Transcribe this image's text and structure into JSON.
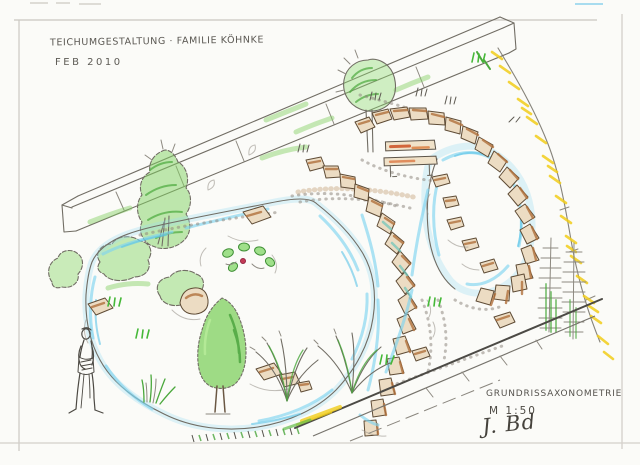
{
  "page": {
    "background": "#fbfbf8",
    "frame_color": "#c9c6c0"
  },
  "annotations": {
    "title": "TEICHUMGESTALTUNG · FAMILIE KÖHNKE",
    "date": "FEB 2010",
    "caption": "GRUNDRISSAXONOMETRIE",
    "scale": "M 1:50",
    "signature": "J. Bd"
  },
  "drawing": {
    "medium": "pencil and colored-pencil freehand sketch",
    "subject": "axonometric garden pond redesign: two ponds joined by a stone cascade, stone retaining arc, wooden beam, bench, trees, grasses and a standing figure",
    "palette": {
      "pencil": "#55524b",
      "foliage_green": "#56c23d",
      "foliage_dark": "#3c9a31",
      "water_blue": "#7fd4f0",
      "stone_tan": "#ecdcc3",
      "stone_brown": "#b0703c",
      "accent_yellow": "#f1cd1a",
      "bench_red": "#cc4f22"
    },
    "elements": [
      "wooden-beam",
      "round-tree",
      "large-shrub",
      "bushes",
      "left-pond",
      "right-pond",
      "stone-wall-arc",
      "stone-cascade",
      "water-lily",
      "garden-bench",
      "conical-tree",
      "person-figure",
      "ornamental-grasses",
      "reeds",
      "conifers",
      "walkway-edge",
      "scattered-stones",
      "yellow-grass-fringe"
    ]
  }
}
